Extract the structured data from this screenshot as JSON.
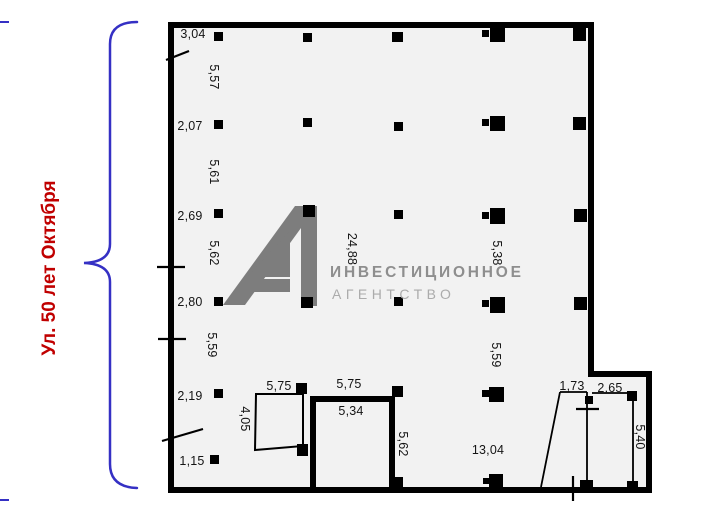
{
  "street": {
    "label": "Ул. 50 лет Октября"
  },
  "watermark": {
    "logo": "A1",
    "line1": "ИНВЕСТИЦИОННОЕ",
    "line2": "АГЕНТСТВО"
  },
  "colors": {
    "street_text": "#c00000",
    "brace": "#3530c4",
    "wall": "#000000",
    "floor_fill": "#f2f2f2",
    "watermark_gray": "#7d7d7d"
  },
  "dimension_labels": [
    {
      "text": "3,04",
      "x": 193,
      "y": 34,
      "rotated": false
    },
    {
      "text": "5,57",
      "x": 214,
      "y": 77,
      "rotated": true
    },
    {
      "text": "2,07",
      "x": 190,
      "y": 126,
      "rotated": false
    },
    {
      "text": "5,61",
      "x": 214,
      "y": 172,
      "rotated": true
    },
    {
      "text": "2,69",
      "x": 190,
      "y": 216,
      "rotated": false
    },
    {
      "text": "5,62",
      "x": 214,
      "y": 253,
      "rotated": true
    },
    {
      "text": "2,80",
      "x": 190,
      "y": 302,
      "rotated": false
    },
    {
      "text": "5,59",
      "x": 212,
      "y": 345,
      "rotated": true
    },
    {
      "text": "2,19",
      "x": 190,
      "y": 396,
      "rotated": false
    },
    {
      "text": "4,05",
      "x": 245,
      "y": 419,
      "rotated": true
    },
    {
      "text": "1,15",
      "x": 192,
      "y": 461,
      "rotated": false
    },
    {
      "text": "24,88",
      "x": 352,
      "y": 249,
      "rotated": true
    },
    {
      "text": "5,38",
      "x": 497,
      "y": 253,
      "rotated": true
    },
    {
      "text": "5,59",
      "x": 496,
      "y": 355,
      "rotated": true
    },
    {
      "text": "5,75",
      "x": 279,
      "y": 386,
      "rotated": false
    },
    {
      "text": "5,75",
      "x": 349,
      "y": 384,
      "rotated": false
    },
    {
      "text": "5,34",
      "x": 351,
      "y": 411,
      "rotated": false
    },
    {
      "text": "5,62",
      "x": 403,
      "y": 444,
      "rotated": true
    },
    {
      "text": "13,04",
      "x": 488,
      "y": 450,
      "rotated": false
    },
    {
      "text": "1,73",
      "x": 572,
      "y": 386,
      "rotated": false
    },
    {
      "text": "2,65",
      "x": 610,
      "y": 388,
      "rotated": false
    },
    {
      "text": "5,40",
      "x": 640,
      "y": 437,
      "rotated": true
    }
  ]
}
